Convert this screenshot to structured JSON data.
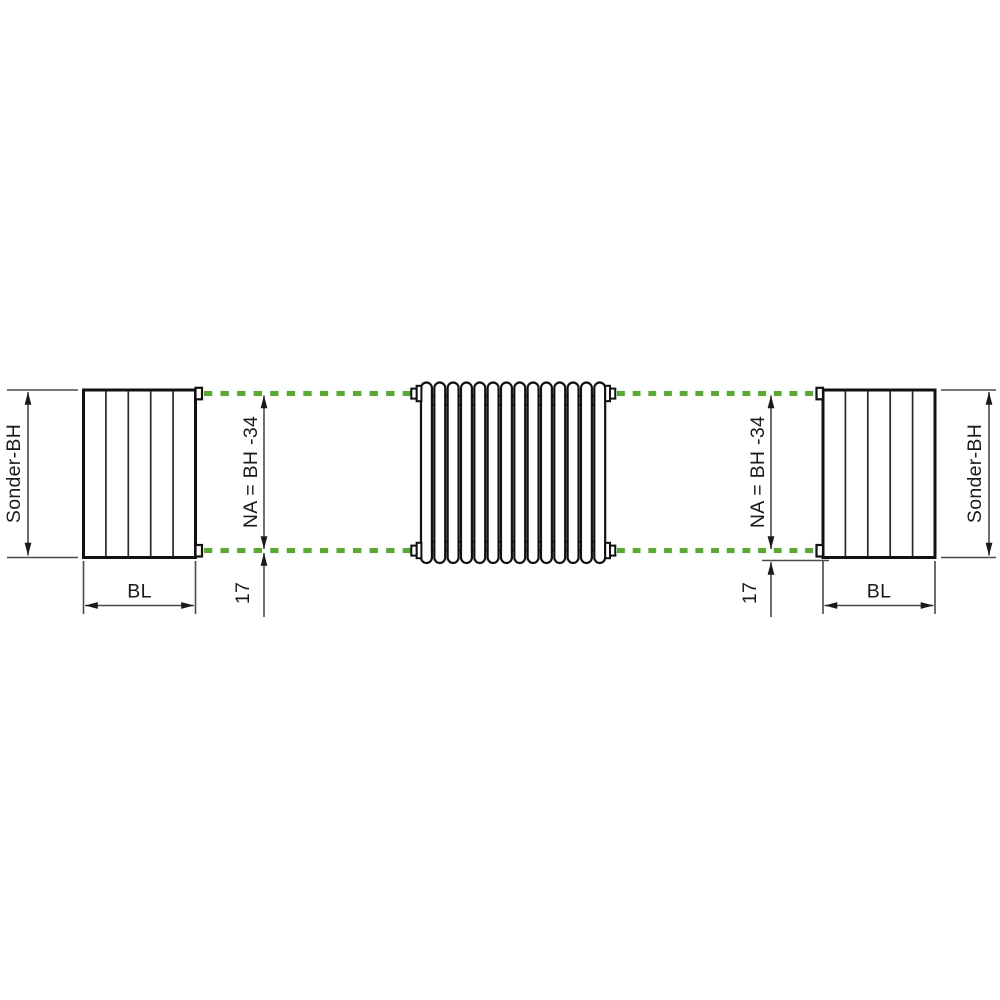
{
  "diagram": {
    "type": "technical-dimension-drawing",
    "description": "Tubular radiator with flat side panels; hub distance and special build height dimensions",
    "colors": {
      "background": "#ffffff",
      "object_line": "#111111",
      "dimension_line": "#4a4a4a",
      "accent_green": "#55ad2c",
      "text": "#1a1a1a"
    },
    "radiator": {
      "tube_count": 14,
      "panel_sections": 5
    },
    "left": {
      "height_label": "Sonder-BH",
      "width_label": "BL",
      "hub_distance_label": "NA = BH -34",
      "bottom_offset_label": "17"
    },
    "right": {
      "height_label": "Sonder-BH",
      "width_label": "BL",
      "hub_distance_label": "NA = BH -34",
      "bottom_offset_label": "17"
    }
  }
}
